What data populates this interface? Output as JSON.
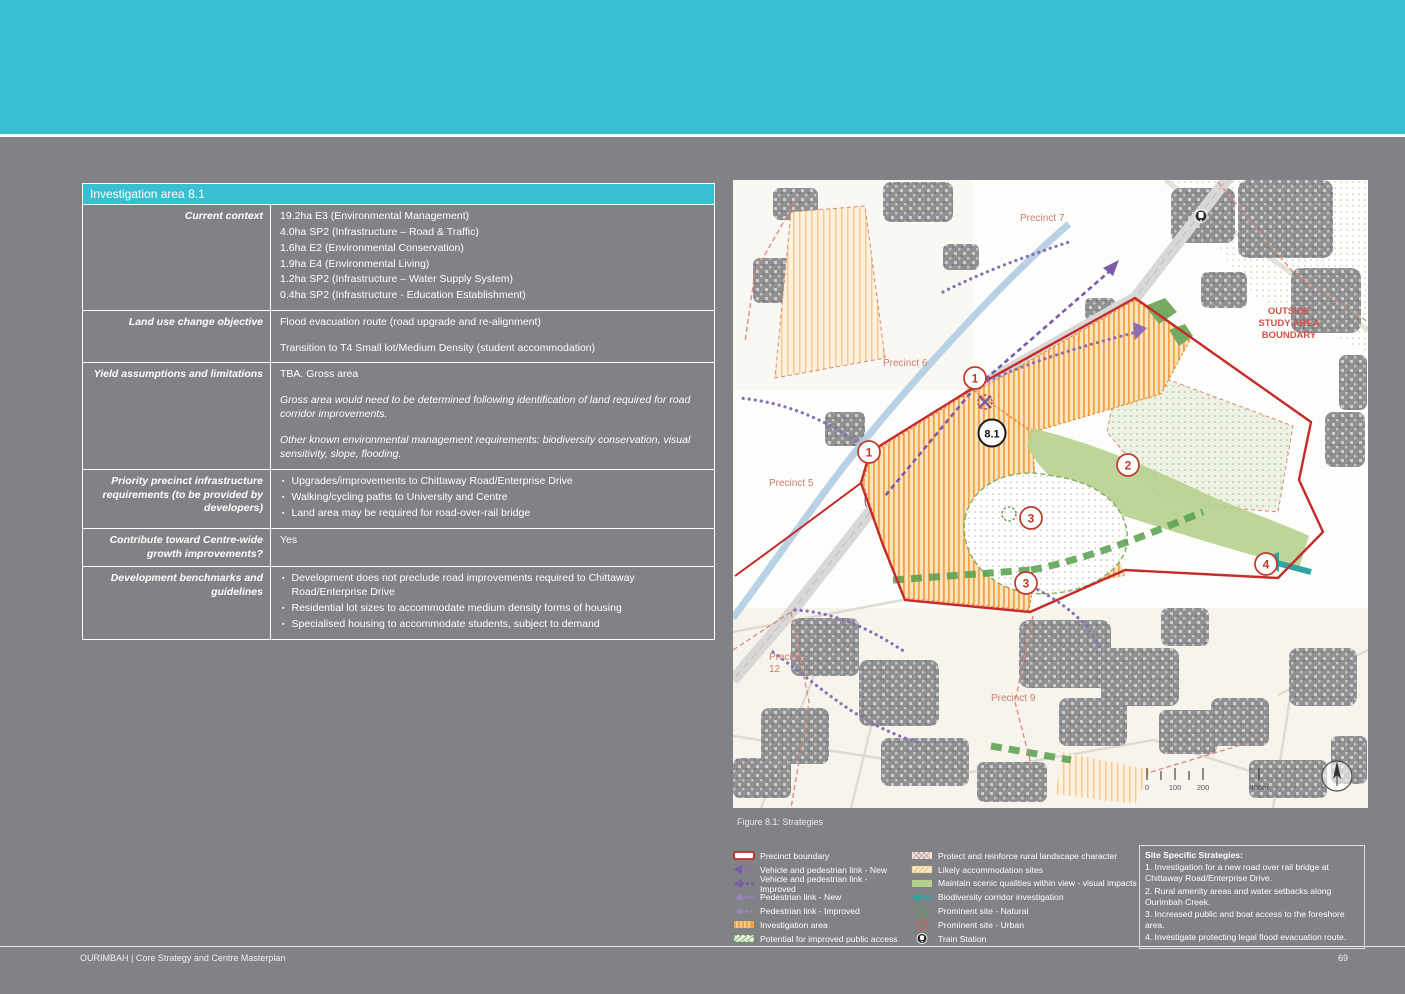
{
  "colors": {
    "accent_teal": "#39bfd2",
    "page_gray": "#818285",
    "boundary_red": "#c62b2b",
    "investigation_orange": "#f2a444",
    "link_purple": "#7a5ca8",
    "corridor_teal": "#2fa3a0",
    "access_green": "#57a04e",
    "creek_blue": "#b5cfe3",
    "marker_red": "#c0392b"
  },
  "table": {
    "title": "Investigation area 8.1",
    "rows": [
      {
        "label": "Current context",
        "lines": [
          "19.2ha E3 (Environmental Management)",
          "4.0ha SP2 (Infrastructure – Road & Traffic)",
          "1.6ha E2 (Environmental Conservation)",
          "1.9ha E4 (Environmental Living)",
          "1.2ha SP2 (Infrastructure – Water Supply System)",
          "0.4ha SP2 (Infrastructure - Education Establishment)"
        ]
      },
      {
        "label": "Land use change objective",
        "lines": [
          "Flood evacuation route (road upgrade and re-alignment)",
          "Transition to T4 Small lot/Medium Density (student accommodation)"
        ]
      },
      {
        "label": "Yield assumptions and limitations",
        "line1": "TBA. Gross area",
        "italic1": "Gross area would need to be determined following identification of land required for road corridor improvements.",
        "italic2": "Other known environmental management requirements: biodiversity conservation, visual sensitivity, slope, flooding."
      },
      {
        "label": "Priority precinct infrastructure requirements (to be provided by developers)",
        "bullets": [
          "Upgrades/improvements to Chittaway Road/Enterprise Drive",
          "Walking/cycling paths to University and Centre",
          "Land area may be required for road-over-rail bridge"
        ]
      },
      {
        "label": "Contribute toward Centre-wide growth improvements?",
        "value": "Yes"
      },
      {
        "label": "Development benchmarks and guidelines",
        "bullets": [
          "Development does not preclude road improvements required to Chittaway Road/Enterprise Drive",
          "Residential lot sizes to accommodate medium density forms of housing",
          "Specialised housing to accommodate students, subject to demand"
        ]
      }
    ]
  },
  "map": {
    "caption": "Figure 8.1: Strategies",
    "labels": {
      "precinct5": "Precinct 5",
      "precinct6": "Precinct 6",
      "precinct7": "Precinct 7",
      "precinct9": "Precinct 9",
      "precinct12_l1": "Precinct",
      "precinct12_l2": "12",
      "outside_l1": "OUTSIDE",
      "outside_l2": "STUDY AREA",
      "outside_l3": "BOUNDARY",
      "area_id": "8.1"
    },
    "markers": {
      "one": "1",
      "two": "2",
      "three": "3",
      "four": "4"
    },
    "scale": {
      "t0": "0",
      "t1": "100",
      "t2": "200",
      "t3": "400m"
    }
  },
  "legend": {
    "col1": [
      {
        "label": "Precinct boundary"
      },
      {
        "label": "Vehicle and pedestrian link - New"
      },
      {
        "label": "Vehicle and pedestrian link - Improved"
      },
      {
        "label": "Pedestrian link - New"
      },
      {
        "label": "Pedestrian link - Improved"
      },
      {
        "label": "Investigation area"
      },
      {
        "label": "Potential for improved public access"
      }
    ],
    "col2": [
      {
        "label": "Protect and reinforce rural landscape character"
      },
      {
        "label": "Likely accommodation sites"
      },
      {
        "label": "Maintain scenic qualities within view - visual impacts"
      },
      {
        "label": "Biodiversity corridor investigation"
      },
      {
        "label": "Prominent site - Natural"
      },
      {
        "label": "Prominent site - Urban"
      },
      {
        "label": "Train Station"
      }
    ]
  },
  "strategies": {
    "title": "Site Specific Strategies:",
    "items": [
      "1. Investigation for a new road over rail bridge at Chittaway Road/Enterprise Drive.",
      "2. Rural amenity areas and water setbacks along Ourimbah Creek.",
      "3. Increased public and boat access to the foreshore area.",
      "4. Investigate protecting legal flood evacuation route."
    ]
  },
  "footer": {
    "left": "OURIMBAH | Core Strategy and Centre Masterplan",
    "page": "69"
  }
}
